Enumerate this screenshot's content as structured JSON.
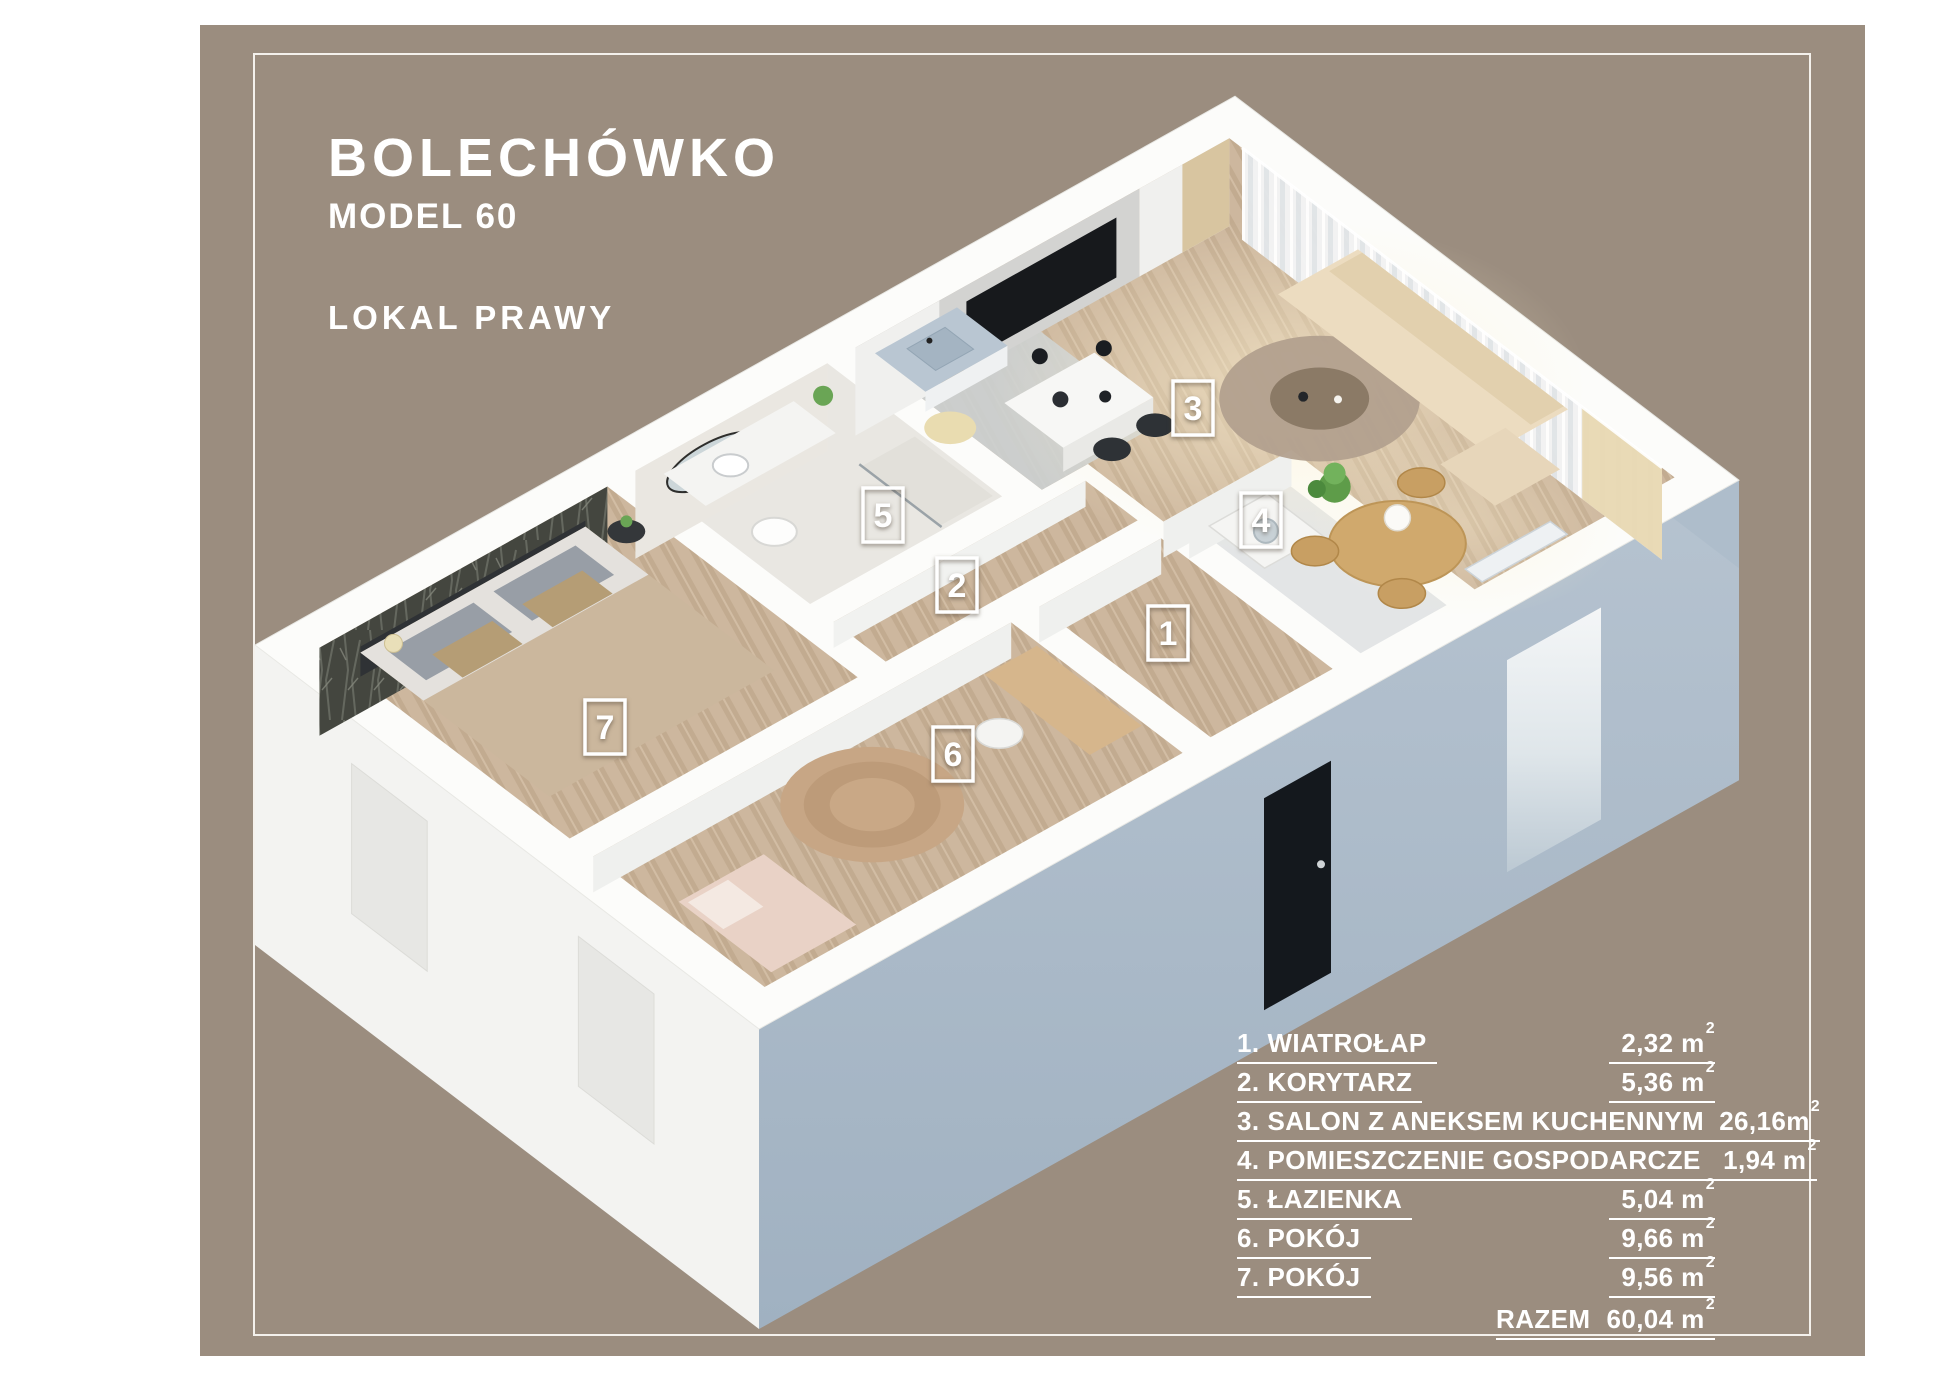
{
  "header": {
    "title": "BOLECHÓWKO",
    "model": "MODEL 60",
    "unit": "LOKAL PRAWY"
  },
  "plan": {
    "labels": [
      {
        "num": "1"
      },
      {
        "num": "2"
      },
      {
        "num": "3"
      },
      {
        "num": "4"
      },
      {
        "num": "5"
      },
      {
        "num": "6"
      },
      {
        "num": "7"
      }
    ]
  },
  "legend": {
    "sup": "2",
    "rows": [
      {
        "num": "1.",
        "name": "WIATROŁAP",
        "area": "2,32 m"
      },
      {
        "num": "2.",
        "name": "KORYTARZ",
        "area": "5,36 m"
      },
      {
        "num": "3.",
        "name": "SALON Z ANEKSEM KUCHENNYM",
        "area": "26,16m"
      },
      {
        "num": "4.",
        "name": "POMIESZCZENIE GOSPODARCZE",
        "area": "1,94 m"
      },
      {
        "num": "5.",
        "name": "ŁAZIENKA",
        "area": "5,04 m"
      },
      {
        "num": "6.",
        "name": "POKÓJ",
        "area": "9,66 m"
      },
      {
        "num": "7.",
        "name": "POKÓJ",
        "area": "9,56 m"
      }
    ],
    "total_label": "RAZEM",
    "total_area": "60,04 m"
  },
  "colors": {
    "background": "#9b8d7f",
    "frame": "#f4f1ec",
    "facade_blue": "#aebdcb",
    "facade_white": "#f3f3f1",
    "entry_door": "#14181d",
    "wood_floor": "#cdb79e",
    "text": "#ffffff"
  }
}
